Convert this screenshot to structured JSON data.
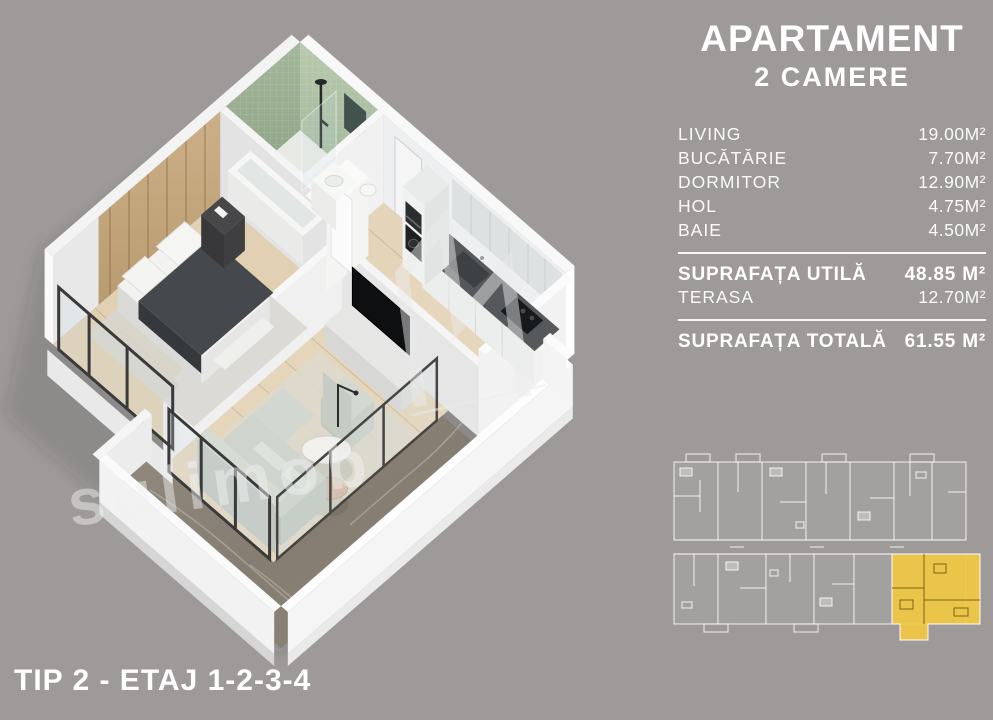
{
  "colors": {
    "background": "#9d9a99",
    "text": "#ffffff",
    "highlight_unit_yellow": "#f0c844",
    "terrace_marble": "#8b8478",
    "bathroom_green": "#a4bb9d",
    "wood_wall": "#c4a77d"
  },
  "panel": {
    "title_line1": "APARTAMENT",
    "title_line2": "2 CAMERE",
    "rooms": [
      {
        "label": "LIVING",
        "value": "19.00M²"
      },
      {
        "label": "BUCĂTĂRIE",
        "value": "7.70M²"
      },
      {
        "label": "DORMITOR",
        "value": "12.90M²"
      },
      {
        "label": "HOL",
        "value": "4.75M²"
      },
      {
        "label": "BAIE",
        "value": "4.50M²"
      }
    ],
    "useful_area": {
      "label": "SUPRAFAȚA UTILĂ",
      "value": "48.85 M²"
    },
    "terrace": {
      "label": "TERASA",
      "value": "12.70M²"
    },
    "total_area": {
      "label": "SUPRAFAȚA TOTALĂ",
      "value": "61.55 M²"
    }
  },
  "footer": {
    "label": "TIP 2 - ETAJ 1-2-3-4"
  },
  "watermark": {
    "text": "sulimob"
  }
}
